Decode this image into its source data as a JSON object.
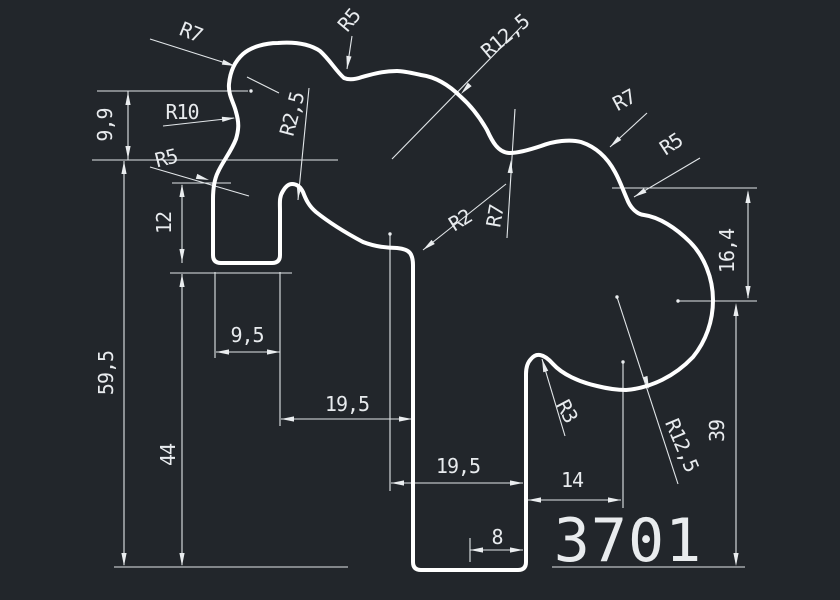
{
  "drawing": {
    "part_number": "3701",
    "background_color": "#22262b",
    "profile_color": "#ffffff",
    "dimension_color": "#e8ebee",
    "radius_labels": [
      {
        "name": "radius-label-r7-top-left",
        "text": "R7",
        "x": 191,
        "y": 32,
        "rot": 22
      },
      {
        "name": "radius-label-r5-top-mid",
        "text": "R5",
        "x": 349,
        "y": 20,
        "rot": -50
      },
      {
        "name": "radius-label-r12-5-top",
        "text": "R12,5",
        "x": 505,
        "y": 36,
        "rot": -40
      },
      {
        "name": "radius-label-r10",
        "text": "R10",
        "x": 182,
        "y": 112,
        "rot": 0
      },
      {
        "name": "radius-label-r2-5",
        "text": "R2,5",
        "x": 292,
        "y": 114,
        "rot": -75
      },
      {
        "name": "radius-label-r5-left",
        "text": "R5",
        "x": 166,
        "y": 158,
        "rot": -14
      },
      {
        "name": "radius-label-r7-top-right",
        "text": "R7",
        "x": 624,
        "y": 100,
        "rot": -28
      },
      {
        "name": "radius-label-r5-right",
        "text": "R5",
        "x": 671,
        "y": 144,
        "rot": -33
      },
      {
        "name": "radius-label-r7-mid",
        "text": "R7",
        "x": 495,
        "y": 216,
        "rot": -80
      },
      {
        "name": "radius-label-r2-mid",
        "text": "R2",
        "x": 460,
        "y": 220,
        "rot": -32
      },
      {
        "name": "radius-label-r3",
        "text": "R3",
        "x": 567,
        "y": 411,
        "rot": 62
      },
      {
        "name": "radius-label-r12-5-bottom",
        "text": "R12,5",
        "x": 682,
        "y": 445,
        "rot": 67
      }
    ],
    "linear_dimensions": [
      {
        "name": "dim-label-9-9",
        "text": "9,9",
        "x": 105,
        "y": 125,
        "rot": -90
      },
      {
        "name": "dim-label-12",
        "text": "12",
        "x": 164,
        "y": 223,
        "rot": -90
      },
      {
        "name": "dim-label-59-5",
        "text": "59,5",
        "x": 106,
        "y": 373,
        "rot": -90
      },
      {
        "name": "dim-label-44",
        "text": "44",
        "x": 168,
        "y": 455,
        "rot": -90
      },
      {
        "name": "dim-label-9-5",
        "text": "9,5",
        "x": 247,
        "y": 335,
        "rot": 0
      },
      {
        "name": "dim-label-19-5-a",
        "text": "19,5",
        "x": 347,
        "y": 404,
        "rot": 0
      },
      {
        "name": "dim-label-19-5-b",
        "text": "19,5",
        "x": 458,
        "y": 466,
        "rot": 0
      },
      {
        "name": "dim-label-8",
        "text": "8",
        "x": 497,
        "y": 537,
        "rot": 0
      },
      {
        "name": "dim-label-14",
        "text": "14",
        "x": 572,
        "y": 480,
        "rot": 0
      },
      {
        "name": "dim-label-16-4",
        "text": "16,4",
        "x": 727,
        "y": 251,
        "rot": -90
      },
      {
        "name": "dim-label-39",
        "text": "39",
        "x": 717,
        "y": 431,
        "rot": -90
      }
    ]
  }
}
